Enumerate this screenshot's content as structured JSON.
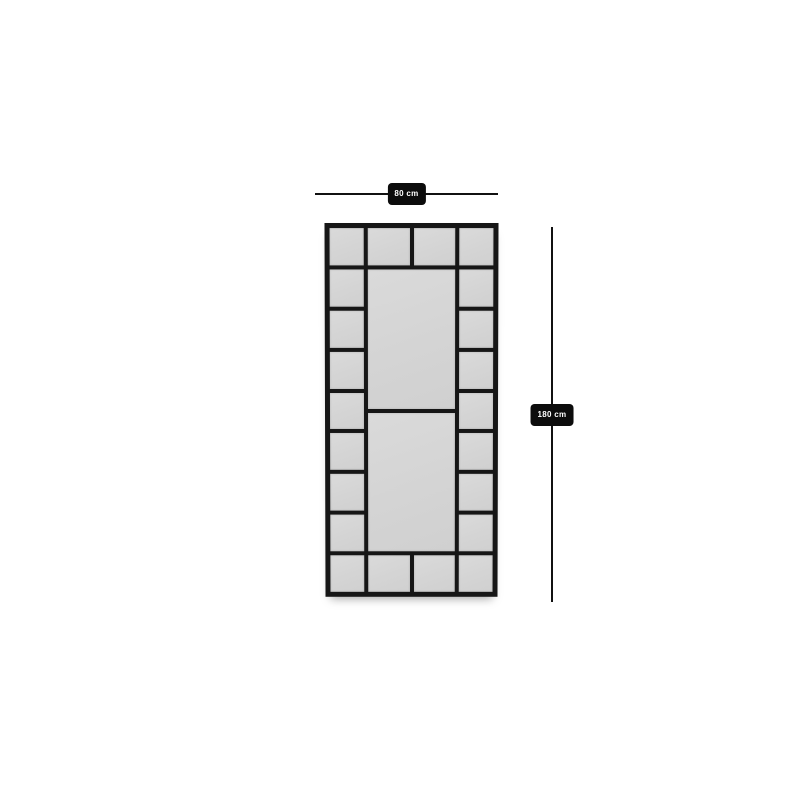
{
  "page": {
    "background_color": "#ffffff"
  },
  "diagram": {
    "kind": "product-dimension-diagram",
    "subject": "grid-pane window mirror, front view",
    "dimensions": {
      "width_label": "80 cm",
      "height_label": "180 cm"
    },
    "structure": {
      "left_column_panes": 9,
      "right_column_panes": 9,
      "top_strip_panes": 2,
      "bottom_strip_panes": 2,
      "center_large_panes": 2,
      "total_panes": 24
    },
    "colors": {
      "frame": "#161616",
      "pane_fill": "#d5d5d5",
      "dimension_line": "#111111",
      "label_background": "#0c0c0c",
      "label_text": "#ffffff"
    }
  }
}
